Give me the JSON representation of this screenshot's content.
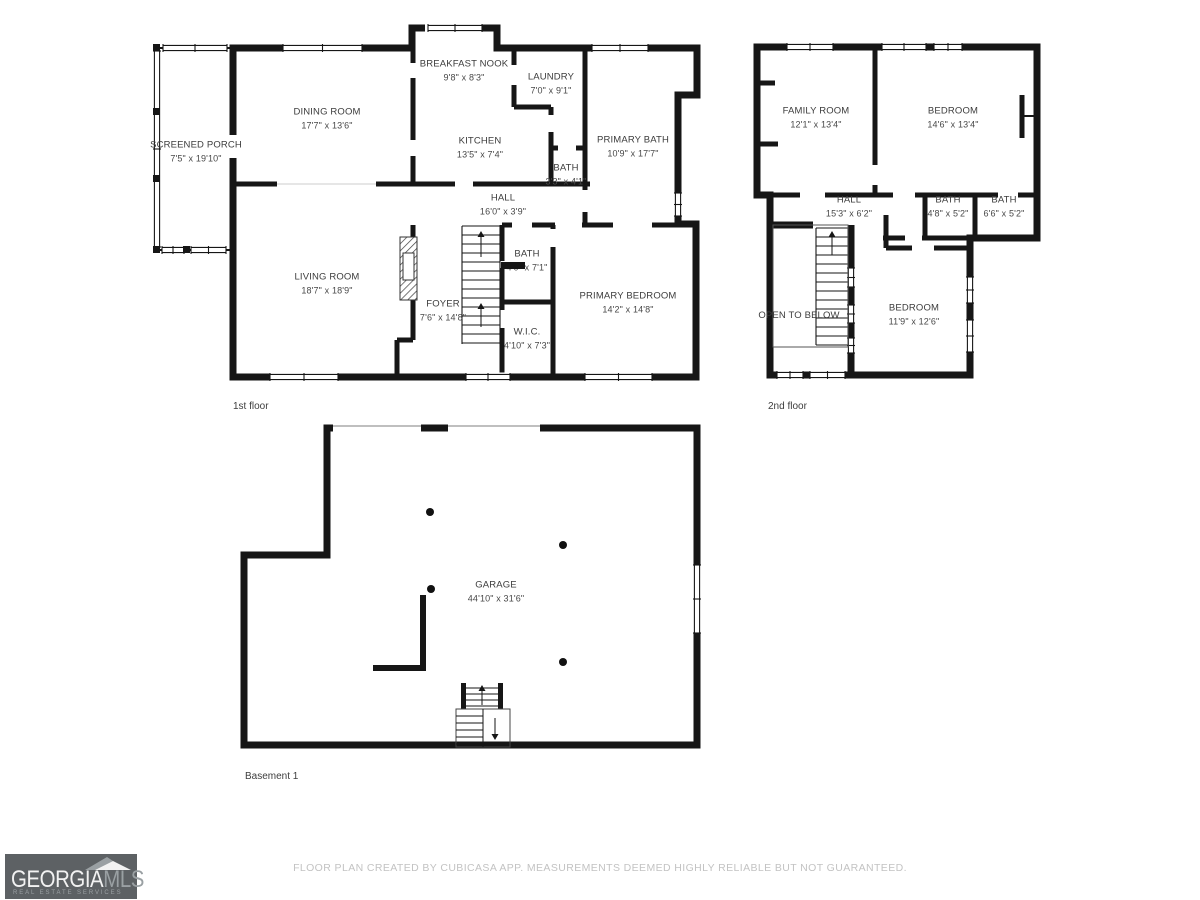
{
  "colors": {
    "wall": "#161616",
    "label_text": "#3c3c3c",
    "footer_text": "#c3c3c3",
    "logo_background": "#5d6164",
    "logo_primary_text": "#f2f2f2",
    "logo_secondary_text": "#9aa0a3"
  },
  "floors": {
    "first": {
      "label": "1st floor",
      "rooms": [
        {
          "name": "SCREENED PORCH",
          "dims": "7'5\" x 19'10\""
        },
        {
          "name": "DINING ROOM",
          "dims": "17'7\" x 13'6\""
        },
        {
          "name": "BREAKFAST NOOK",
          "dims": "9'8\" x 8'3\""
        },
        {
          "name": "LAUNDRY",
          "dims": "7'0\" x 9'1\""
        },
        {
          "name": "KITCHEN",
          "dims": "13'5\" x 7'4\""
        },
        {
          "name": "BATH",
          "dims": "3'3\" x 4'1\""
        },
        {
          "name": "PRIMARY BATH",
          "dims": "10'9\" x 17'7\""
        },
        {
          "name": "HALL",
          "dims": "16'0\" x 3'9\""
        },
        {
          "name": "LIVING ROOM",
          "dims": "18'7\" x 18'9\""
        },
        {
          "name": "FOYER",
          "dims": "7'6\" x 14'8\""
        },
        {
          "name": "BATH",
          "dims": "4'0\" x 7'1\""
        },
        {
          "name": "W.I.C.",
          "dims": "4'10\" x 7'3\""
        },
        {
          "name": "PRIMARY BEDROOM",
          "dims": "14'2\" x 14'8\""
        }
      ]
    },
    "second": {
      "label": "2nd floor",
      "rooms": [
        {
          "name": "FAMILY ROOM",
          "dims": "12'1\" x 13'4\""
        },
        {
          "name": "BEDROOM",
          "dims": "14'6\" x 13'4\""
        },
        {
          "name": "HALL",
          "dims": "15'3\" x 6'2\""
        },
        {
          "name": "BATH",
          "dims": "4'8\" x 5'2\""
        },
        {
          "name": "BATH",
          "dims": "6'6\" x 5'2\""
        },
        {
          "name": "OPEN TO BELOW"
        },
        {
          "name": "BEDROOM",
          "dims": "11'9\" x 12'6\""
        }
      ]
    },
    "basement": {
      "label": "Basement 1",
      "rooms": [
        {
          "name": "GARAGE",
          "dims": "44'10\" x 31'6\""
        }
      ]
    }
  },
  "footer": {
    "disclaimer": "FLOOR PLAN CREATED BY CUBICASA APP. MEASUREMENTS DEEMED HIGHLY RELIABLE BUT NOT GUARANTEED."
  },
  "logo": {
    "primary": "GEORGIA",
    "secondary": "MLS",
    "tagline": "REAL ESTATE SERVICES"
  }
}
